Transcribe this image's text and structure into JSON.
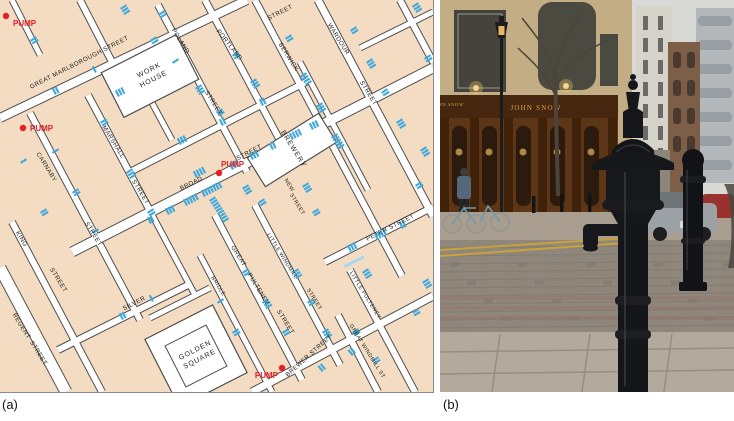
{
  "figure": {
    "panel_a_label": "(a)",
    "panel_b_label": "(b)"
  },
  "map": {
    "colors": {
      "land": "#f3dcc2",
      "street": "#ffffff",
      "outline": "#4f4f4f",
      "deaths_bar": "#3fa9dd",
      "deaths_bar_light": "#a5d8f0",
      "pump_red": "#e32025",
      "label_ink": "#1c1c1c"
    },
    "pump_label": "PUMP",
    "pumps": [
      {
        "x": 6,
        "y": 16,
        "lx": 13,
        "ly": 26,
        "anchor": "start"
      },
      {
        "x": 23,
        "y": 128,
        "lx": 30,
        "ly": 131,
        "anchor": "start"
      },
      {
        "x": 219,
        "y": 173,
        "lx": 221,
        "ly": 167,
        "anchor": "start"
      },
      {
        "x": 282,
        "y": 368,
        "lx": 278,
        "ly": 378,
        "anchor": "end"
      }
    ],
    "street_labels": [
      {
        "t": "GREAT  MARLBOROUGH  STREET",
        "x": 80,
        "y": 64,
        "r": -27,
        "s": 6.2
      },
      {
        "t": "POLAND",
        "x": 179,
        "y": 42,
        "r": 58
      },
      {
        "t": "STREET",
        "x": 212,
        "y": 104,
        "r": 58
      },
      {
        "t": "PORTLAND",
        "x": 228,
        "y": 46,
        "r": 52
      },
      {
        "t": "STREET",
        "x": 281,
        "y": 14,
        "r": -27
      },
      {
        "t": "BERWICK",
        "x": 287,
        "y": 58,
        "r": 58
      },
      {
        "t": "WARDOUR",
        "x": 337,
        "y": 40,
        "r": 58
      },
      {
        "t": "STREET",
        "x": 367,
        "y": 94,
        "r": 58
      },
      {
        "t": "MARSHALL",
        "x": 112,
        "y": 143,
        "r": 58
      },
      {
        "t": "STREET",
        "x": 139,
        "y": 193,
        "r": 58
      },
      {
        "t": "CARNABY",
        "x": 45,
        "y": 168,
        "r": 58
      },
      {
        "t": "STREET",
        "x": 92,
        "y": 235,
        "r": 58
      },
      {
        "t": "KING",
        "x": 20,
        "y": 240,
        "r": 58
      },
      {
        "t": "STREET",
        "x": 57,
        "y": 281,
        "r": 58
      },
      {
        "t": "REGENT",
        "x": 20,
        "y": 327,
        "r": 58
      },
      {
        "t": "STREET",
        "x": 37,
        "y": 354,
        "r": 58
      },
      {
        "t": "SILVER",
        "x": 135,
        "y": 305,
        "r": -27
      },
      {
        "t": "BROAD",
        "x": 192,
        "y": 185,
        "r": -27
      },
      {
        "t": "STREET",
        "x": 250,
        "y": 154,
        "r": -27
      },
      {
        "t": "NEW",
        "x": 288,
        "y": 186,
        "r": 58,
        "s": 5.4
      },
      {
        "t": "STREET",
        "x": 296,
        "y": 205,
        "r": 58,
        "s": 5.4
      },
      {
        "t": "PETER  STREET",
        "x": 391,
        "y": 229,
        "r": -27
      },
      {
        "t": "GREAT",
        "x": 237,
        "y": 257,
        "r": 58
      },
      {
        "t": "PULTENEY",
        "x": 257,
        "y": 290,
        "r": 58
      },
      {
        "t": "STREET",
        "x": 284,
        "y": 323,
        "r": 58
      },
      {
        "t": "BRIDLE",
        "x": 217,
        "y": 287,
        "r": 58,
        "s": 5.4
      },
      {
        "t": "LITTLE  WINDMILL",
        "x": 281,
        "y": 257,
        "r": 58,
        "s": 5.4
      },
      {
        "t": "STREET",
        "x": 313,
        "y": 300,
        "r": 58,
        "s": 5.4
      },
      {
        "t": "LITTLE  PULTENEY",
        "x": 364,
        "y": 296,
        "r": 58,
        "s": 5.4
      },
      {
        "t": "GREAT  WINDMILL  ST",
        "x": 366,
        "y": 352,
        "r": 58,
        "s": 5.4
      },
      {
        "t": "BREWER  STREET",
        "x": 310,
        "y": 357,
        "r": -42
      }
    ],
    "places": [
      {
        "lines": [
          "WORK",
          "HOUSE"
        ],
        "x": 150,
        "y": 72,
        "r": -27
      },
      {
        "lines": [
          "GOLDEN",
          "SQUARE"
        ],
        "x": 196,
        "y": 352,
        "r": -27
      },
      {
        "lines": [
          "BREWERY"
        ],
        "x": 292,
        "y": 150,
        "r": 58
      }
    ],
    "highlight_bar": {
      "x": 345,
      "y": 268,
      "r": -27,
      "len": 22
    },
    "bar_clusters": [
      [
        120,
        8,
        58,
        3
      ],
      [
        158,
        14,
        58,
        2
      ],
      [
        30,
        40,
        58,
        2
      ],
      [
        55,
        95,
        -27,
        2
      ],
      [
        95,
        73,
        -27,
        1
      ],
      [
        150,
        40,
        58,
        2
      ],
      [
        172,
        62,
        58,
        1
      ],
      [
        195,
        88,
        58,
        3
      ],
      [
        216,
        112,
        58,
        2
      ],
      [
        118,
        97,
        -27,
        3
      ],
      [
        232,
        55,
        58,
        2
      ],
      [
        250,
        82,
        58,
        3
      ],
      [
        285,
        38,
        58,
        2
      ],
      [
        300,
        76,
        58,
        4
      ],
      [
        316,
        106,
        58,
        3
      ],
      [
        331,
        137,
        58,
        5
      ],
      [
        350,
        30,
        58,
        2
      ],
      [
        366,
        62,
        58,
        3
      ],
      [
        381,
        92,
        58,
        2
      ],
      [
        396,
        122,
        58,
        3
      ],
      [
        412,
        6,
        58,
        3
      ],
      [
        424,
        58,
        58,
        2
      ],
      [
        180,
        145,
        -27,
        3
      ],
      [
        222,
        126,
        -27,
        2
      ],
      [
        262,
        106,
        -27,
        2
      ],
      [
        100,
        122,
        58,
        2
      ],
      [
        126,
        172,
        58,
        3
      ],
      [
        147,
        212,
        58,
        2
      ],
      [
        52,
        152,
        58,
        1
      ],
      [
        72,
        192,
        58,
        2
      ],
      [
        92,
        232,
        58,
        1
      ],
      [
        20,
        162,
        58,
        1
      ],
      [
        40,
        212,
        58,
        2
      ],
      [
        150,
        224,
        -27,
        2
      ],
      [
        168,
        215,
        -27,
        3
      ],
      [
        186,
        206,
        -27,
        5
      ],
      [
        204,
        197,
        -27,
        7
      ],
      [
        209,
        200,
        58,
        9
      ],
      [
        196,
        178,
        -27,
        4
      ],
      [
        232,
        170,
        -27,
        3
      ],
      [
        252,
        160,
        -27,
        3
      ],
      [
        272,
        150,
        -27,
        2
      ],
      [
        292,
        140,
        -27,
        4
      ],
      [
        312,
        130,
        -27,
        3
      ],
      [
        242,
        188,
        58,
        3
      ],
      [
        258,
        202,
        58,
        2
      ],
      [
        302,
        186,
        58,
        3
      ],
      [
        312,
        212,
        58,
        2
      ],
      [
        350,
        252,
        -27,
        3
      ],
      [
        377,
        240,
        -27,
        4
      ],
      [
        402,
        229,
        -27,
        2
      ],
      [
        362,
        272,
        58,
        3
      ],
      [
        242,
        272,
        58,
        2
      ],
      [
        262,
        302,
        58,
        3
      ],
      [
        282,
        332,
        58,
        2
      ],
      [
        217,
        302,
        58,
        1
      ],
      [
        232,
        332,
        58,
        2
      ],
      [
        292,
        272,
        58,
        3
      ],
      [
        307,
        302,
        58,
        2
      ],
      [
        322,
        332,
        58,
        3
      ],
      [
        352,
        332,
        58,
        2
      ],
      [
        372,
        360,
        58,
        2
      ],
      [
        412,
        312,
        58,
        2
      ],
      [
        422,
        282,
        58,
        3
      ],
      [
        122,
        320,
        -27,
        2
      ],
      [
        152,
        302,
        -27,
        1
      ],
      [
        322,
        372,
        -40,
        2
      ],
      [
        352,
        356,
        -40,
        2
      ],
      [
        420,
        150,
        58,
        3
      ],
      [
        415,
        185,
        58,
        2
      ]
    ]
  },
  "photo": {
    "pub_sign": "JOHN SNOW",
    "colors": {
      "pump_iron": "#16171a",
      "pub_wood": "#5d3517",
      "sign_gold": "#d8a43c",
      "sky": "#d9d9d5"
    }
  }
}
